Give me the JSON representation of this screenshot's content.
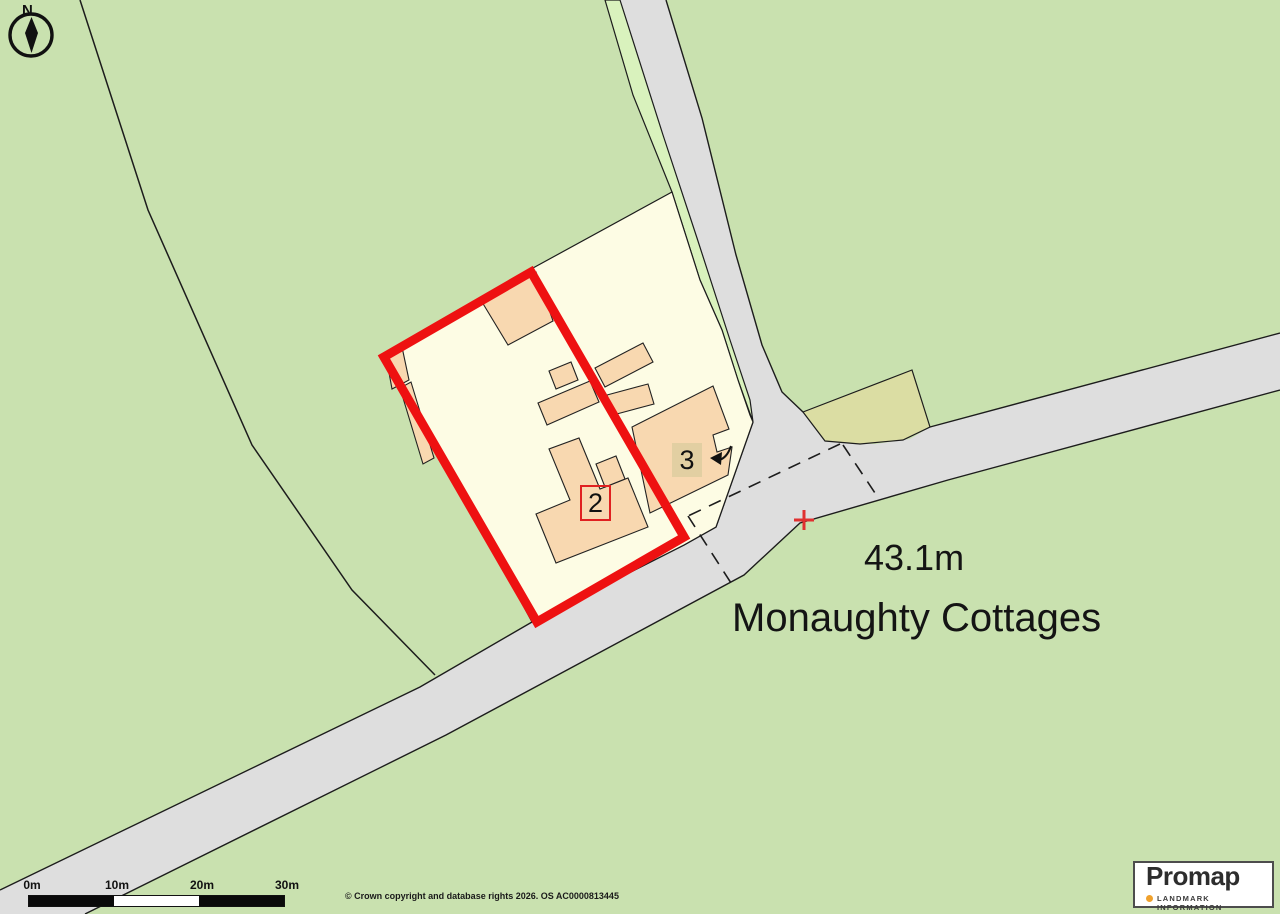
{
  "map": {
    "north_label": "N",
    "place_name": "Monaughty Cottages",
    "spot_height": "43.1m",
    "plot_labels": {
      "plot2": "2",
      "plot3": "3"
    },
    "colors": {
      "field_green": "#c9e1af",
      "verge_green": "#d9f2bd",
      "road_grey": "#dedede",
      "parcel_cream": "#fdfce4",
      "building_peach": "#f8d8b0",
      "parcel_khaki": "#dbdda3",
      "boundary_red": "#ee1111",
      "marker_red": "#e03030"
    }
  },
  "scale_bar": {
    "ticks": [
      "0m",
      "10m",
      "20m",
      "30m"
    ]
  },
  "attribution": {
    "copyright": "© Crown copyright and database rights 2026. OS AC0000813445"
  },
  "branding": {
    "name": "Promap",
    "tagline": "LANDMARK INFORMATION"
  }
}
